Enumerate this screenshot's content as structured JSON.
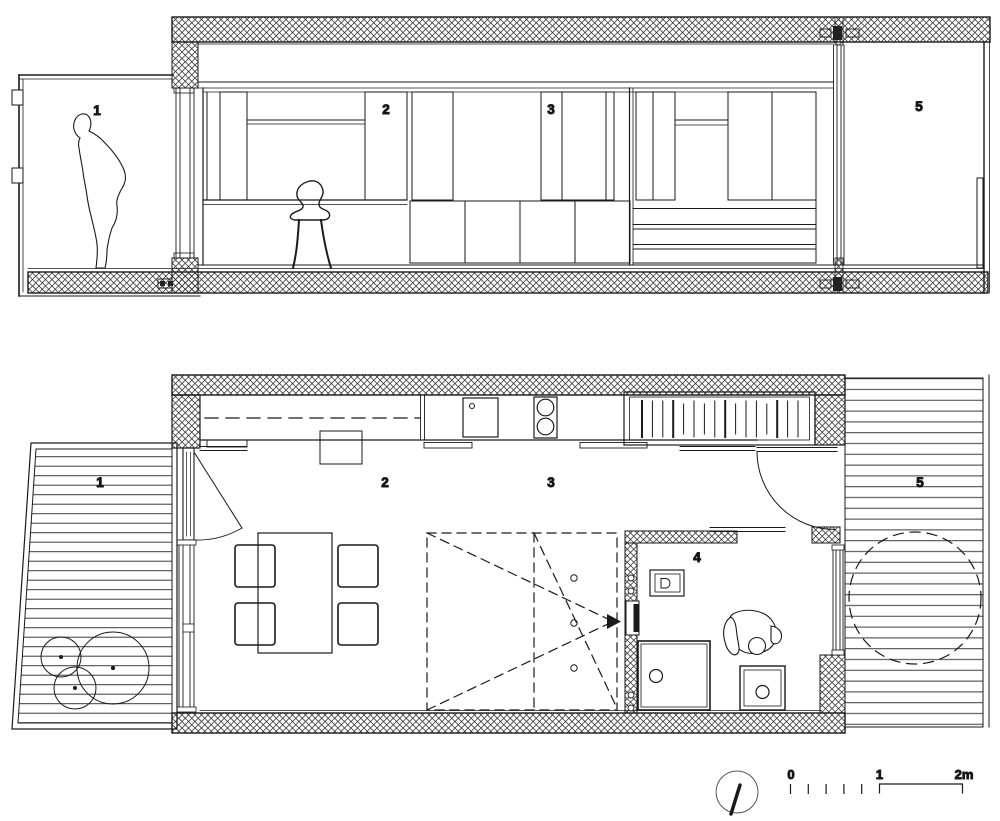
{
  "section_view": {
    "room_labels": {
      "r1": "1",
      "r2": "2",
      "r3": "3",
      "r5": "5"
    }
  },
  "plan_view": {
    "room_labels": {
      "r1": "1",
      "r2": "2",
      "r3": "3",
      "r4": "4",
      "r5": "5"
    }
  },
  "scale_bar": {
    "zero": "0",
    "one": "1",
    "two_m": "2m"
  },
  "colors": {
    "line": "#1a1a1a",
    "background": "#ffffff"
  },
  "symbols": {
    "north_indicator": "circle-with-needle",
    "wall_fill": "crosshatch",
    "deck_fill": "horizontal-planks"
  }
}
